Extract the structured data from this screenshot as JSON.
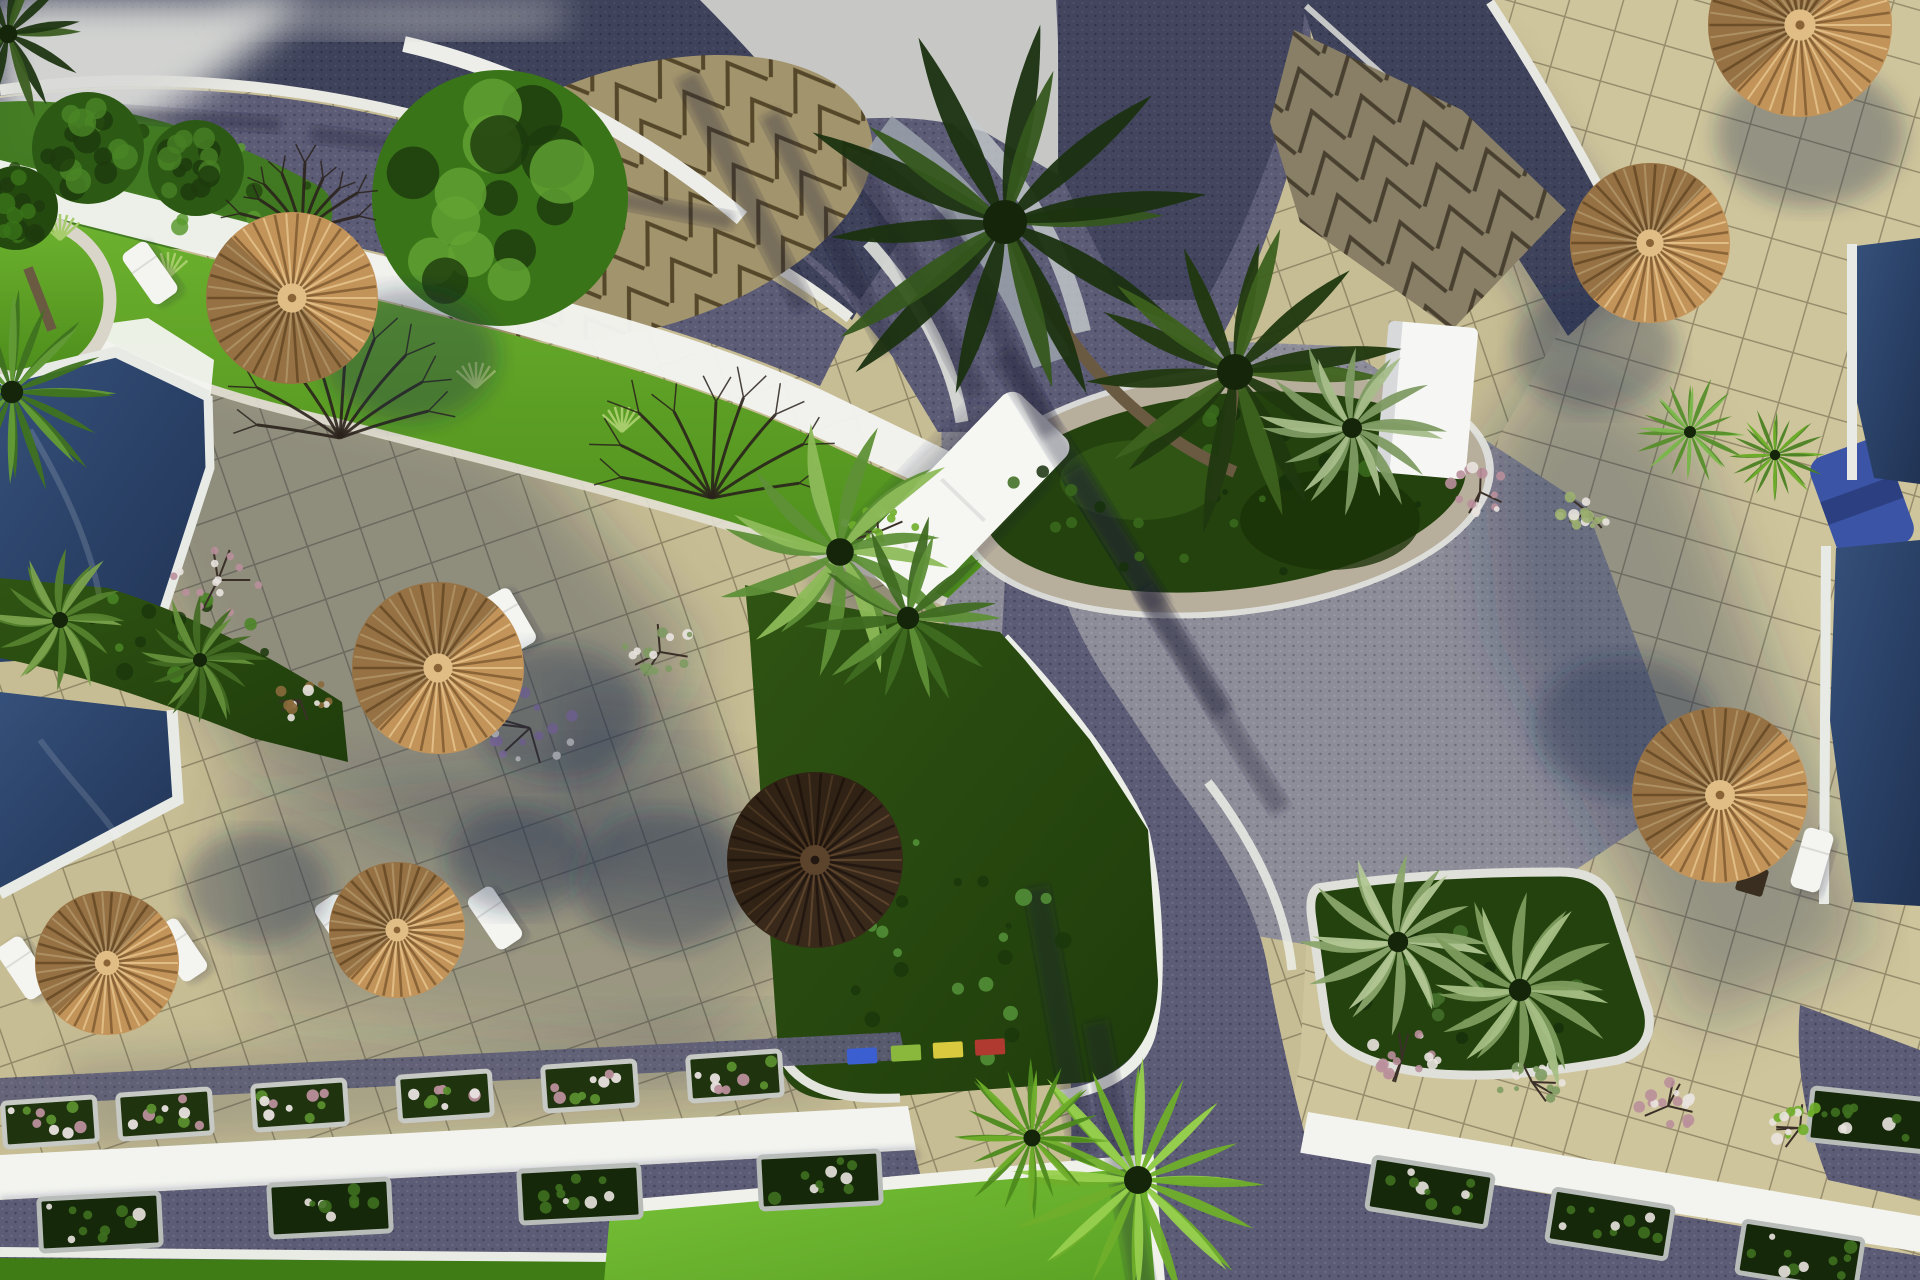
{
  "scene": {
    "description": "Aerial 3D architectural rendering of a seaside resort courtyard: navy swimming pools with white decks on the left and right edges, beige tiled sun terraces with straw parasols and white sun loungers, a curved white building with a triangle-patterned cone roof at top, purple paved walkways crossing the grounds, a circular palm planter at the centre, green lawns, flower planters and palm trees",
    "canvas": {
      "width": 1920,
      "height": 1280
    },
    "palette": {
      "terrace": "#c7bd94",
      "terraceRight": "#cfc59c",
      "grout": "rgba(75,64,42,0.42)",
      "sky": "#c7c8c5",
      "cloud": "#dadbd8",
      "roadBase": "#5c5c76",
      "roadDark": "#3e425a",
      "roadGray": "#8d8d99",
      "white": "#eff0ec",
      "wallWhite": "#f3f4f0",
      "curb": "#e7e8e1",
      "poolHi": "#35507a",
      "poolLo": "#203354",
      "poolRim": "#e8eae6",
      "lawnHi": "#6db22f",
      "lawnLo": "#4c8c1b",
      "lawnHi2": "#79c238",
      "lawnLo2": "#5aa224",
      "lawnDark": "#3f7c16",
      "hill": "#3f7a1e",
      "bedHi": "#2f5413",
      "bedLo": "#1f3c0b",
      "strawLight": "#e0bd85",
      "straw": "#c3945a",
      "strawDark": "#8a6437",
      "darkUmb": "#39291a",
      "darkUmbDark": "#231811",
      "darkUmbLight": "#5c432c",
      "trunk": "#6b5a42",
      "branch": "#2a221c",
      "cone": "#b4a67a",
      "coneLine": "#5d4e2f",
      "grayArc": "#9ba2ab",
      "grayArc2": "#c6cacd",
      "tarp": "#3b54a6",
      "shadow": "rgba(30,45,75,0.33)",
      "pink": "#b98f9b",
      "lavender": "#9278ab",
      "flowerWhite": "#e9e3df",
      "boxSoil": "#1e330e",
      "boxCurb": "#c6c9c4",
      "hedgeCurb": "#b9bdb9"
    }
  },
  "umbrellas": [
    {
      "x": 292,
      "y": 298,
      "r": 86,
      "variant": "light",
      "shadow": {
        "dx": 118,
        "dy": 58
      },
      "shade": -135
    },
    {
      "x": 438,
      "y": 668,
      "r": 86,
      "variant": "light",
      "shadow": {
        "dx": 120,
        "dy": 45
      },
      "shade": -45
    },
    {
      "x": 107,
      "y": 963,
      "r": 72,
      "variant": "light",
      "shadow": {
        "dx": 150,
        "dy": -75
      },
      "shade": -45
    },
    {
      "x": 397,
      "y": 930,
      "r": 68,
      "variant": "light",
      "shadow": {
        "dx": 120,
        "dy": -70
      },
      "shade": -45
    },
    {
      "x": 815,
      "y": 860,
      "r": 88,
      "variant": "dark",
      "shadow": {
        "dx": -150,
        "dy": 20
      },
      "shade": -45
    },
    {
      "x": 1650,
      "y": 243,
      "r": 80,
      "variant": "light",
      "shadow": {
        "dx": -55,
        "dy": 105
      },
      "shade": -45
    },
    {
      "x": 1720,
      "y": 795,
      "r": 88,
      "variant": "light",
      "shadow": {
        "dx": -95,
        "dy": -70
      },
      "shade": -45
    },
    {
      "x": 1800,
      "y": 25,
      "r": 92,
      "variant": "light",
      "shadow": {
        "dx": 10,
        "dy": 110
      },
      "shade": -45
    }
  ],
  "loungers": [
    {
      "x": 150,
      "y": 273,
      "rot": -35
    },
    {
      "x": 24,
      "y": 968,
      "rot": -34
    },
    {
      "x": 180,
      "y": 950,
      "rot": -34
    },
    {
      "x": 342,
      "y": 926,
      "rot": -34
    },
    {
      "x": 495,
      "y": 918,
      "rot": -34
    },
    {
      "x": 510,
      "y": 620,
      "rot": -30
    },
    {
      "x": 1812,
      "y": 860,
      "rot": 16
    }
  ],
  "tables": [
    {
      "x": 1752,
      "y": 880,
      "rot": 16
    }
  ],
  "palms": [
    {
      "type": "palm",
      "x": 1005,
      "y": 222,
      "r": 220,
      "c": "#1b3110",
      "tip": "#35571c",
      "trunk": [
        1235,
        472
      ]
    },
    {
      "type": "palm",
      "x": 1235,
      "y": 372,
      "r": 180,
      "c": "#20380f",
      "tip": "#3d611e",
      "trunk": [
        1210,
        500
      ]
    },
    {
      "type": "fern",
      "x": 1352,
      "y": 428,
      "r": 100,
      "c": "#7e9b63",
      "tip": "#a7bd8a"
    },
    {
      "type": "plume",
      "x": 840,
      "y": 552,
      "r": 138,
      "c": "#5f9038",
      "tip": "#8dbb59"
    },
    {
      "type": "palm",
      "x": 908,
      "y": 618,
      "r": 112,
      "c": "#3f6b22",
      "tip": "#5f9038"
    },
    {
      "type": "fan",
      "x": 1138,
      "y": 1180,
      "r": 140,
      "c": "#6fae2a",
      "tip": "#97cf4e"
    },
    {
      "type": "fan",
      "x": 1032,
      "y": 1138,
      "r": 85,
      "c": "#4e8a1e",
      "tip": "#6fae2a"
    },
    {
      "type": "fan",
      "x": 12,
      "y": 392,
      "r": 112,
      "c": "#3f7220",
      "tip": "#639b37"
    },
    {
      "type": "palm",
      "x": 8,
      "y": 34,
      "r": 92,
      "c": "#1e3512",
      "tip": "#3a5c20"
    },
    {
      "type": "fern",
      "x": 1398,
      "y": 942,
      "r": 102,
      "c": "#8aa56b",
      "tip": "#b1c693"
    },
    {
      "type": "fern",
      "x": 1520,
      "y": 990,
      "r": 112,
      "c": "#7d9c5d",
      "tip": "#a6bf85"
    },
    {
      "type": "fan",
      "x": 1690,
      "y": 432,
      "r": 60,
      "c": "#568e2b",
      "tip": "#7cb84d"
    },
    {
      "type": "fan",
      "x": 1775,
      "y": 455,
      "r": 52,
      "c": "#4b8124",
      "tip": "#6fae2a"
    },
    {
      "type": "fern",
      "x": 60,
      "y": 620,
      "r": 80,
      "c": "#55822f",
      "tip": "#7aa24c"
    },
    {
      "type": "fern",
      "x": 200,
      "y": 660,
      "r": 70,
      "c": "#436c24",
      "tip": "#648f3a"
    }
  ],
  "canopies": [
    {
      "x": 500,
      "y": 198,
      "r": 128,
      "c": "#3a7419",
      "hi": "#62a332"
    },
    {
      "x": 88,
      "y": 148,
      "r": 56,
      "c": "#2c5a14",
      "hi": "#4a8526"
    },
    {
      "x": 196,
      "y": 168,
      "r": 48,
      "c": "#2c5a14",
      "hi": "#477f24"
    },
    {
      "x": 16,
      "y": 208,
      "r": 42,
      "c": "#24490f",
      "hi": "#3a7419"
    }
  ],
  "bareTrees": [
    {
      "x": 340,
      "y": 438,
      "spread": 200
    },
    {
      "x": 712,
      "y": 498,
      "spread": 185
    },
    {
      "x": 302,
      "y": 232,
      "spread": 120
    }
  ],
  "shrubs": [
    {
      "x": 218,
      "y": 580,
      "r": 46,
      "c": "#b98f9b"
    },
    {
      "x": 530,
      "y": 728,
      "r": 52,
      "c": "#9278ab"
    },
    {
      "x": 660,
      "y": 652,
      "r": 40,
      "c": "#7e9b63"
    },
    {
      "x": 878,
      "y": 532,
      "r": 38,
      "c": "#6fae2a"
    },
    {
      "x": 1480,
      "y": 492,
      "r": 34,
      "c": "#b98f9b"
    },
    {
      "x": 1588,
      "y": 512,
      "r": 30,
      "c": "#9bb06f"
    },
    {
      "x": 1402,
      "y": 1058,
      "r": 36,
      "c": "#b98f9b"
    },
    {
      "x": 1532,
      "y": 1082,
      "r": 34,
      "c": "#7e9b63"
    },
    {
      "x": 1668,
      "y": 1106,
      "r": 36,
      "c": "#b98f9b"
    },
    {
      "x": 1800,
      "y": 1128,
      "r": 34,
      "c": "#6fae2a"
    },
    {
      "x": 300,
      "y": 700,
      "r": 30,
      "c": "#8a6a3c"
    }
  ],
  "tufts": [
    {
      "x": 168,
      "y": 278
    },
    {
      "x": 322,
      "y": 330
    },
    {
      "x": 476,
      "y": 388
    },
    {
      "x": 622,
      "y": 432
    },
    {
      "x": 60,
      "y": 240
    }
  ],
  "flowerBoxes": [
    {
      "x": 50,
      "y": 1122,
      "rot": -4
    },
    {
      "x": 165,
      "y": 1114,
      "rot": -4
    },
    {
      "x": 300,
      "y": 1105,
      "rot": -4
    },
    {
      "x": 445,
      "y": 1096,
      "rot": -4
    },
    {
      "x": 590,
      "y": 1086,
      "rot": -4
    },
    {
      "x": 735,
      "y": 1076,
      "rot": -4
    }
  ],
  "hedgeBoxes": [
    {
      "x": 100,
      "y": 1222,
      "rot": -3
    },
    {
      "x": 330,
      "y": 1208,
      "rot": -3
    },
    {
      "x": 580,
      "y": 1194,
      "rot": -3
    },
    {
      "x": 820,
      "y": 1180,
      "rot": -3
    },
    {
      "x": 1430,
      "y": 1192,
      "rot": 9
    },
    {
      "x": 1610,
      "y": 1224,
      "rot": 9
    },
    {
      "x": 1800,
      "y": 1256,
      "rot": 9
    },
    {
      "x": 1870,
      "y": 1120,
      "rot": 6
    }
  ],
  "markers": [
    {
      "x": 862,
      "y": 1056,
      "c": "#3b5fd0"
    },
    {
      "x": 906,
      "y": 1053,
      "c": "#8ab83c"
    },
    {
      "x": 948,
      "y": 1050,
      "c": "#d8c93f"
    },
    {
      "x": 990,
      "y": 1047,
      "c": "#b03a30"
    }
  ],
  "roadStripes": [
    {
      "x": 745,
      "y": 192,
      "l": 260,
      "w": 24,
      "rot": 63
    },
    {
      "x": 830,
      "y": 232,
      "l": 265,
      "w": 22,
      "rot": 63
    },
    {
      "x": 915,
      "y": 275,
      "l": 270,
      "w": 24,
      "rot": 63
    },
    {
      "x": 995,
      "y": 322,
      "l": 250,
      "w": 22,
      "rot": 63
    },
    {
      "x": 1080,
      "y": 480,
      "l": 300,
      "w": 26,
      "rot": 58
    },
    {
      "x": 1148,
      "y": 592,
      "l": 285,
      "w": 24,
      "rot": 58
    },
    {
      "x": 1212,
      "y": 700,
      "l": 260,
      "w": 22,
      "rot": 58
    },
    {
      "x": 425,
      "y": 148,
      "l": 230,
      "w": 18,
      "rot": 7
    },
    {
      "x": 612,
      "y": 198,
      "l": 245,
      "w": 18,
      "rot": 11
    },
    {
      "x": 180,
      "y": 118,
      "l": 200,
      "w": 16,
      "rot": 4
    },
    {
      "x": 1060,
      "y": 1020,
      "l": 270,
      "w": 26,
      "rot": 80
    },
    {
      "x": 1120,
      "y": 1160,
      "l": 280,
      "w": 26,
      "rot": 80
    }
  ],
  "dotFields": [
    {
      "x": 1225,
      "y": 492,
      "rx": 220,
      "ry": 85,
      "n": 26,
      "c": "#16300a",
      "hi": "#3a6a1c"
    },
    {
      "x": 1480,
      "y": 975,
      "rx": 140,
      "ry": 70,
      "n": 18,
      "c": "#16300a",
      "hi": "#44702a"
    },
    {
      "x": 955,
      "y": 950,
      "rx": 110,
      "ry": 130,
      "n": 22,
      "c": "#1b370c",
      "hi": "#55933a"
    },
    {
      "x": 170,
      "y": 640,
      "rx": 150,
      "ry": 45,
      "n": 14,
      "c": "#1b370c",
      "hi": "#4a8526"
    },
    {
      "x": 160,
      "y": 180,
      "rx": 150,
      "ry": 55,
      "n": 16,
      "c": "#24490f",
      "hi": "#5a9a30"
    }
  ]
}
